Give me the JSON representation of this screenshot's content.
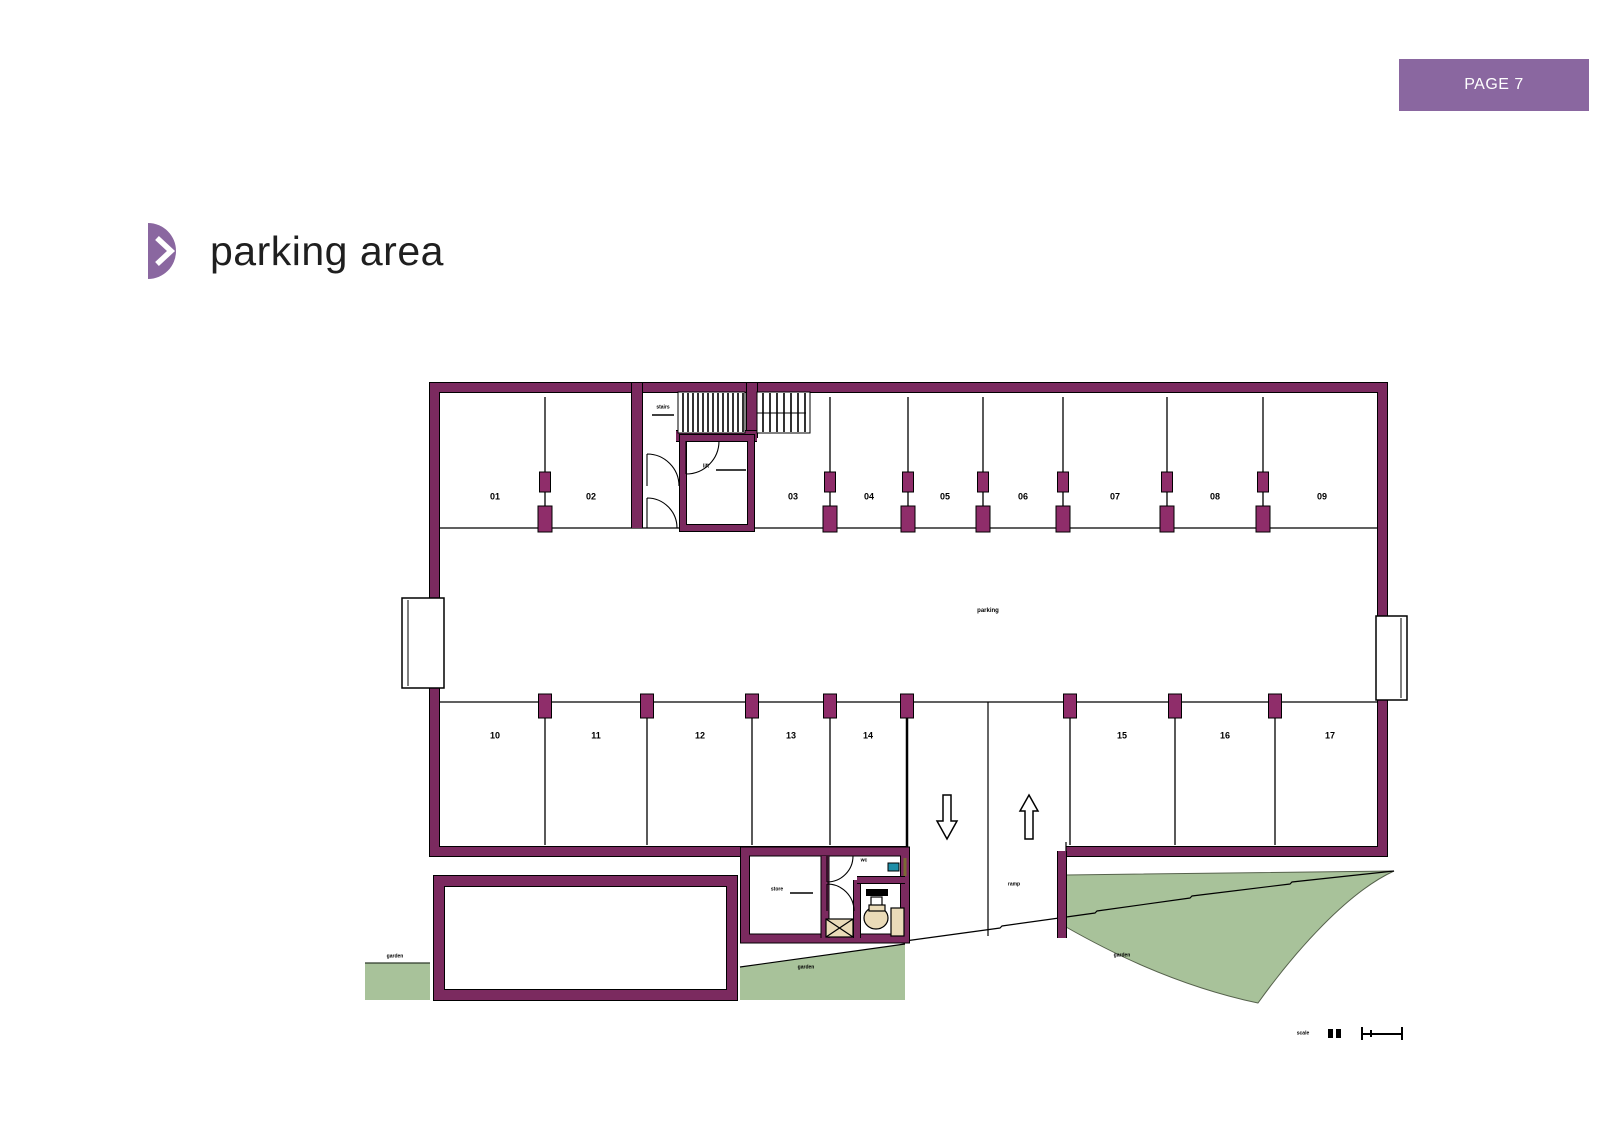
{
  "header": {
    "page_badge": "PAGE 7"
  },
  "title": {
    "text": "parking area"
  },
  "plan": {
    "stalls_top": [
      "01",
      "02",
      "03",
      "04",
      "05",
      "06",
      "07",
      "08",
      "09"
    ],
    "stalls_bottom": [
      "10",
      "11",
      "12",
      "13",
      "14",
      "15",
      "16",
      "17"
    ],
    "labels": {
      "stairs": "stairs",
      "lift": "lift",
      "aisle": "parking",
      "store": "store",
      "wc": "wc",
      "ramp": "ramp",
      "garden_left": "garden",
      "garden_mid": "garden",
      "garden_right": "garden",
      "scale": "scale"
    },
    "colors": {
      "wall": "#7b2a5f",
      "pilaster": "#8f2d6a",
      "accent": "#8a67a0",
      "green": "#a8c29a",
      "beige": "#eadbb8",
      "teal": "#1f8fa8"
    }
  }
}
